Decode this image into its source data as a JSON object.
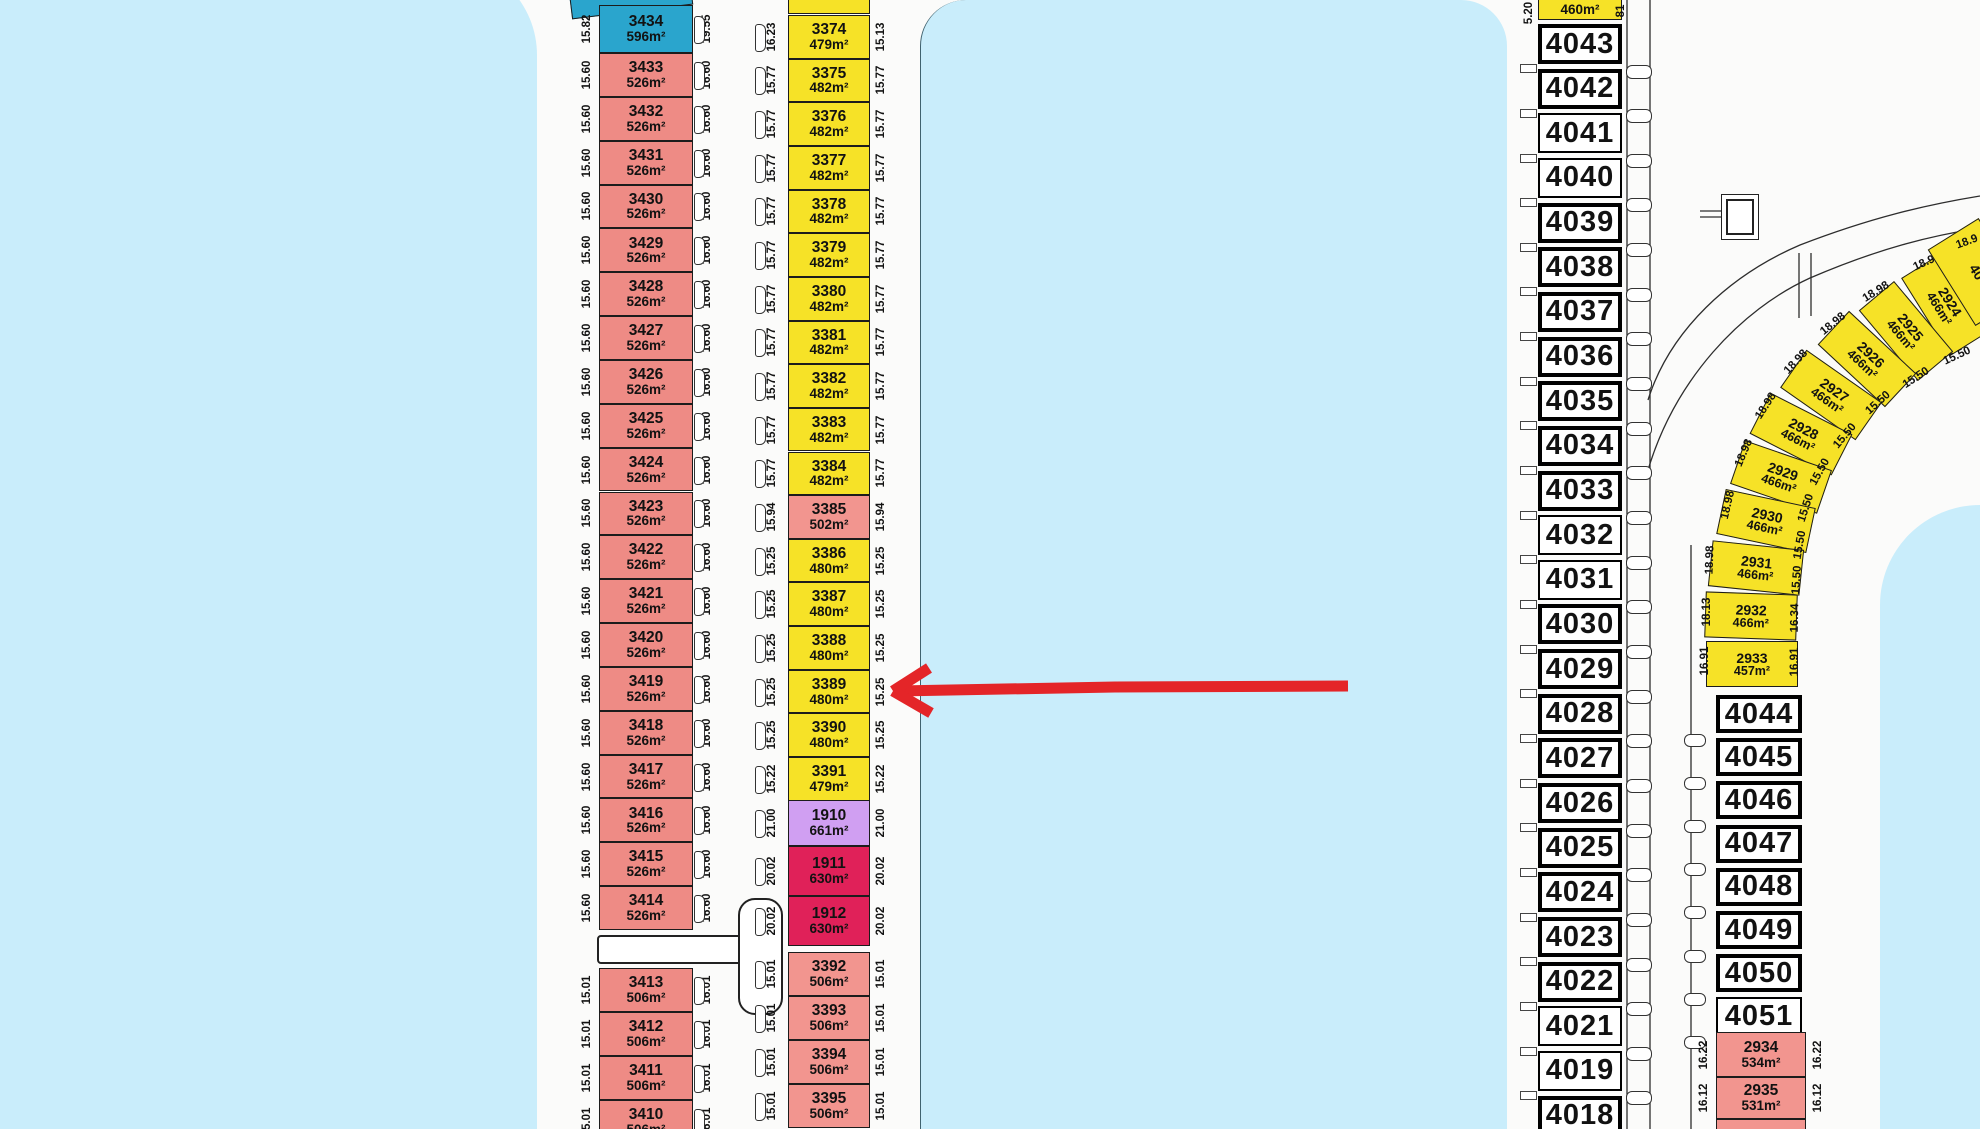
{
  "map_title": "subdivision-plat",
  "colors": {
    "water": "#c9edfb",
    "salmon": "#ee8b85",
    "salmon_light": "#f2958f",
    "yellow": "#f6e227",
    "blue_lot": "#2aa5cd",
    "purple_lot": "#d09ff2",
    "crimson_lot": "#e02159",
    "arrow": "#e42528",
    "outline": "#1c1c1c"
  },
  "left_column": {
    "upper_lots": [
      {
        "id": "3434",
        "area": "596m²",
        "left": "15.82",
        "right": "19.55",
        "color": "blue"
      },
      {
        "id": "3433",
        "area": "526m²",
        "left": "15.60",
        "right": "16.60"
      },
      {
        "id": "3432",
        "area": "526m²",
        "left": "15.60",
        "right": "16.60"
      },
      {
        "id": "3431",
        "area": "526m²",
        "left": "15.60",
        "right": "16.60"
      },
      {
        "id": "3430",
        "area": "526m²",
        "left": "15.60",
        "right": "16.60"
      },
      {
        "id": "3429",
        "area": "526m²",
        "left": "15.60",
        "right": "16.60"
      },
      {
        "id": "3428",
        "area": "526m²",
        "left": "15.60",
        "right": "16.60"
      },
      {
        "id": "3427",
        "area": "526m²",
        "left": "15.60",
        "right": "16.60"
      },
      {
        "id": "3426",
        "area": "526m²",
        "left": "15.60",
        "right": "16.60"
      },
      {
        "id": "3425",
        "area": "526m²",
        "left": "15.60",
        "right": "16.60"
      },
      {
        "id": "3424",
        "area": "526m²",
        "left": "15.60",
        "right": "16.60"
      },
      {
        "id": "3423",
        "area": "526m²",
        "left": "15.60",
        "right": "16.60"
      },
      {
        "id": "3422",
        "area": "526m²",
        "left": "15.60",
        "right": "16.60"
      },
      {
        "id": "3421",
        "area": "526m²",
        "left": "15.60",
        "right": "16.60"
      },
      {
        "id": "3420",
        "area": "526m²",
        "left": "15.60",
        "right": "16.60"
      },
      {
        "id": "3419",
        "area": "526m²",
        "left": "15.60",
        "right": "16.60"
      },
      {
        "id": "3418",
        "area": "526m²",
        "left": "15.60",
        "right": "16.60"
      },
      {
        "id": "3417",
        "area": "526m²",
        "left": "15.60",
        "right": "16.60"
      },
      {
        "id": "3416",
        "area": "526m²",
        "left": "15.60",
        "right": "16.60"
      },
      {
        "id": "3415",
        "area": "526m²",
        "left": "15.60",
        "right": "16.60"
      },
      {
        "id": "3414",
        "area": "526m²",
        "left": "15.60",
        "right": "16.60"
      }
    ],
    "lower_lots": [
      {
        "id": "3413",
        "area": "506m²",
        "left": "15.01",
        "right": "16.01"
      },
      {
        "id": "3412",
        "area": "506m²",
        "left": "15.01",
        "right": "16.01"
      },
      {
        "id": "3411",
        "area": "506m²",
        "left": "15.01",
        "right": "16.01"
      },
      {
        "id": "3410",
        "area": "506m²",
        "left": "15.01",
        "right": "16.01"
      }
    ]
  },
  "middle_column": {
    "upper_lots": [
      {
        "id": "3374",
        "area": "479m²",
        "left": "16.23",
        "right": "15.13",
        "color": "yellow"
      },
      {
        "id": "3375",
        "area": "482m²",
        "left": "15.77",
        "right": "15.77",
        "color": "yellow"
      },
      {
        "id": "3376",
        "area": "482m²",
        "left": "15.77",
        "right": "15.77",
        "color": "yellow"
      },
      {
        "id": "3377",
        "area": "482m²",
        "left": "15.77",
        "right": "15.77",
        "color": "yellow"
      },
      {
        "id": "3378",
        "area": "482m²",
        "left": "15.77",
        "right": "15.77",
        "color": "yellow"
      },
      {
        "id": "3379",
        "area": "482m²",
        "left": "15.77",
        "right": "15.77",
        "color": "yellow"
      },
      {
        "id": "3380",
        "area": "482m²",
        "left": "15.77",
        "right": "15.77",
        "color": "yellow"
      },
      {
        "id": "3381",
        "area": "482m²",
        "left": "15.77",
        "right": "15.77",
        "color": "yellow"
      },
      {
        "id": "3382",
        "area": "482m²",
        "left": "15.77",
        "right": "15.77",
        "color": "yellow"
      },
      {
        "id": "3383",
        "area": "482m²",
        "left": "15.77",
        "right": "15.77",
        "color": "yellow"
      },
      {
        "id": "3384",
        "area": "482m²",
        "left": "15.77",
        "right": "15.77",
        "color": "yellow"
      },
      {
        "id": "3385",
        "area": "502m²",
        "left": "15.94",
        "right": "15.94",
        "color": "salmon_light"
      },
      {
        "id": "3386",
        "area": "480m²",
        "left": "15.25",
        "right": "15.25",
        "color": "yellow"
      },
      {
        "id": "3387",
        "area": "480m²",
        "left": "15.25",
        "right": "15.25",
        "color": "yellow"
      },
      {
        "id": "3388",
        "area": "480m²",
        "left": "15.25",
        "right": "15.25",
        "color": "yellow"
      },
      {
        "id": "3389",
        "area": "480m²",
        "left": "15.25",
        "right": "15.25",
        "color": "yellow"
      },
      {
        "id": "3390",
        "area": "480m²",
        "left": "15.25",
        "right": "15.25",
        "color": "yellow"
      },
      {
        "id": "3391",
        "area": "479m²",
        "left": "15.22",
        "right": "15.22",
        "color": "yellow"
      },
      {
        "id": "1910",
        "area": "661m²",
        "left": "21.00",
        "right": "21.00",
        "color": "purple_lot"
      },
      {
        "id": "1911",
        "area": "630m²",
        "left": "20.02",
        "right": "20.02",
        "color": "crimson_lot"
      },
      {
        "id": "1912",
        "area": "630m²",
        "left": "20.02",
        "right": "20.02",
        "color": "crimson_lot"
      }
    ],
    "lower_lots": [
      {
        "id": "3392",
        "area": "506m²",
        "left": "15.01",
        "right": "15.01"
      },
      {
        "id": "3393",
        "area": "506m²",
        "left": "15.01",
        "right": "15.01"
      },
      {
        "id": "3394",
        "area": "506m²",
        "left": "15.01",
        "right": "15.01"
      },
      {
        "id": "3395",
        "area": "506m²",
        "left": "15.01",
        "right": "15.01"
      }
    ]
  },
  "right_column": {
    "partial_top": {
      "area": "460m²",
      "left_dim": "5.20",
      "right_dim": "81"
    },
    "lots": [
      {
        "id": "4043",
        "border": "thick"
      },
      {
        "id": "4042",
        "border": "thick"
      },
      {
        "id": "4041",
        "border": "thin"
      },
      {
        "id": "4040",
        "border": "thin"
      },
      {
        "id": "4039",
        "border": "thick"
      },
      {
        "id": "4038",
        "border": "thick"
      },
      {
        "id": "4037",
        "border": "thick"
      },
      {
        "id": "4036",
        "border": "thick"
      },
      {
        "id": "4035",
        "border": "thick"
      },
      {
        "id": "4034",
        "border": "thick"
      },
      {
        "id": "4033",
        "border": "thick"
      },
      {
        "id": "4032",
        "border": "thin"
      },
      {
        "id": "4031",
        "border": "thin"
      },
      {
        "id": "4030",
        "border": "thick"
      },
      {
        "id": "4029",
        "border": "thick"
      },
      {
        "id": "4028",
        "border": "thick"
      },
      {
        "id": "4027",
        "border": "thick"
      },
      {
        "id": "4026",
        "border": "thick"
      },
      {
        "id": "4025",
        "border": "thick"
      },
      {
        "id": "4024",
        "border": "thick"
      },
      {
        "id": "4023",
        "border": "thick"
      },
      {
        "id": "4022",
        "border": "thick"
      },
      {
        "id": "4021",
        "border": "thin"
      },
      {
        "id": "4019",
        "border": "thin"
      },
      {
        "id": "4018",
        "border": "thick"
      }
    ]
  },
  "arc_lots": {
    "lots": [
      {
        "id": "2924",
        "area": "466m²",
        "outer": "18.98",
        "inner": "15.50"
      },
      {
        "id": "2925",
        "area": "466m²",
        "outer": "18.98",
        "inner": "15.50"
      },
      {
        "id": "2926",
        "area": "466m²",
        "outer": "18.98",
        "inner": "15.50"
      },
      {
        "id": "2927",
        "area": "466m²",
        "outer": "18.98",
        "inner": "15.50"
      },
      {
        "id": "2928",
        "area": "466m²",
        "outer": "18.98",
        "inner": "15.50"
      },
      {
        "id": "2929",
        "area": "466m²",
        "outer": "18.98",
        "inner": "15.50"
      },
      {
        "id": "2930",
        "area": "466m²",
        "outer": "18.98",
        "inner": "15.50"
      },
      {
        "id": "2931",
        "area": "466m²",
        "outer": "18.98",
        "inner": "15.50"
      },
      {
        "id": "2932",
        "area": "466m²",
        "outer": "18.13",
        "inner": "16.34"
      },
      {
        "id": "2933",
        "area": "457m²",
        "outer": "16.91",
        "inner": "16.91"
      }
    ],
    "edge_fragment": "40",
    "partial_outer_dim": "18.9"
  },
  "east_column": {
    "lots": [
      {
        "id": "4044",
        "border": "thick"
      },
      {
        "id": "4045",
        "border": "thick"
      },
      {
        "id": "4046",
        "border": "thick"
      },
      {
        "id": "4047",
        "border": "thick"
      },
      {
        "id": "4048",
        "border": "thick"
      },
      {
        "id": "4049",
        "border": "thick"
      },
      {
        "id": "4050",
        "border": "thick"
      },
      {
        "id": "4051",
        "border": "thin"
      }
    ],
    "pink_lots": [
      {
        "id": "2934",
        "area": "534m²",
        "left": "16.22",
        "right": "16.22"
      },
      {
        "id": "2935",
        "area": "531m²",
        "left": "16.12",
        "right": "16.12"
      },
      {
        "id": "2936",
        "area": "",
        "left": "",
        "right": ""
      }
    ]
  },
  "arrow": {
    "color": "#e42528"
  }
}
